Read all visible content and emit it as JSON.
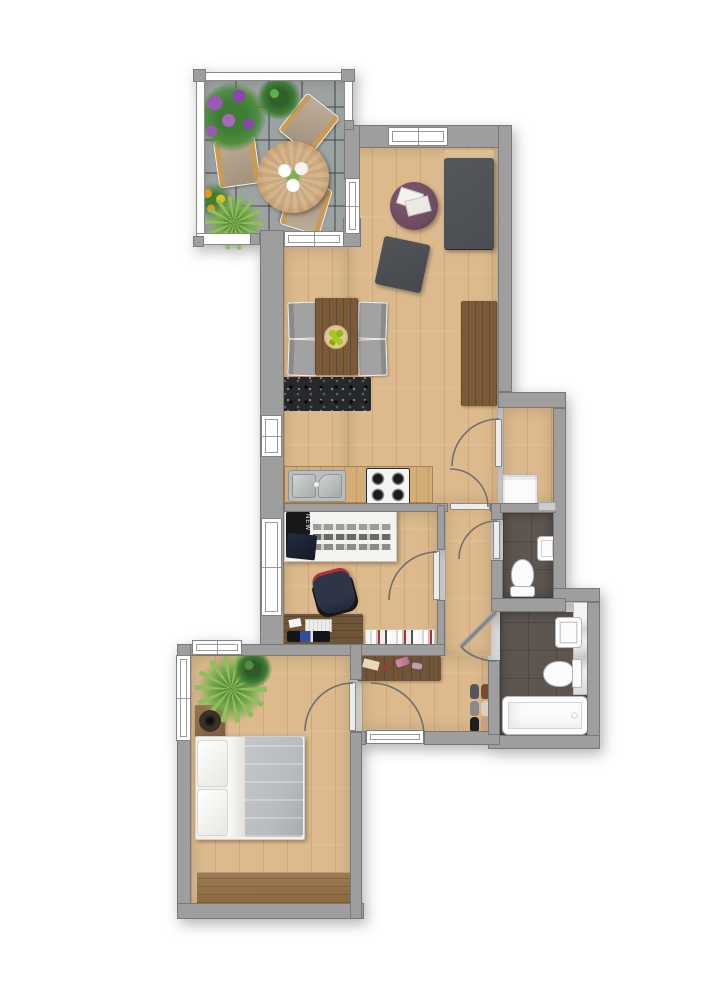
{
  "meta": {
    "type": "floor-plan",
    "description": "Top-down rendered apartment floor plan with terrace, living-dining room with open kitchen, office room, laundry niche, WC, bathroom, hallway and bedroom"
  },
  "texts": {
    "pillow": "NEW YORK"
  },
  "colors": {
    "wall": "#9e9e9e",
    "wood": "#dcba8d",
    "woodDark": "#7b5a39",
    "terraceTile": "#9da3a2",
    "bathTile": "#5d5550",
    "sofa": "#4a4d51",
    "sofaBack": "#d9c18f",
    "pouf": "#6e4b60",
    "ottoman": "#45484c",
    "chairGray": "#a2a2a2",
    "rug": "#26282a",
    "fixtureWhite": "#fbfbfb",
    "duvet": "#b9bcbf",
    "navy": "#2e3546",
    "bookRed": "#b03030",
    "plantLight": "#8fbf5a",
    "plantDark": "#3f7d35",
    "flowerPurple": "#9b59b6",
    "marigold": "#e8960f",
    "apple": "#a8c820",
    "seatTan": "#b7a795",
    "tableWood": "#c9a273"
  },
  "rooms": [
    {
      "id": "terrace",
      "items": [
        "railing",
        "stone-tiles",
        "purple-flower-bush",
        "fern-plant",
        "folding-chair",
        "folding-chair",
        "folding-chair",
        "round-table",
        "white-flower-centerpiece",
        "marigold-plant",
        "yucca-plant"
      ]
    },
    {
      "id": "living-dining-room",
      "items": [
        "sofa",
        "coffee-table-pouf",
        "magazines",
        "ottoman",
        "dining-table",
        "fruit-bowl",
        "dining-chair",
        "dining-chair",
        "dining-chair",
        "dining-chair",
        "speckled-rug",
        "sideboard"
      ]
    },
    {
      "id": "kitchen",
      "items": [
        "counter",
        "double-sink",
        "gas-stove"
      ]
    },
    {
      "id": "office-room",
      "items": [
        "single-bed",
        "skyline-duvet",
        "new-york-pillow",
        "desk-chair",
        "desk",
        "paper",
        "keyboard",
        "laptop",
        "mouse",
        "bookshelf"
      ]
    },
    {
      "id": "laundry-niche",
      "items": [
        "washing-machine",
        "threshold"
      ]
    },
    {
      "id": "wc",
      "items": [
        "hand-sink",
        "toilet"
      ]
    },
    {
      "id": "bathroom",
      "items": [
        "marble-panel",
        "washbasin",
        "toilet",
        "bathtub"
      ]
    },
    {
      "id": "hallway",
      "items": [
        "console-table",
        "cosmetics",
        "shoes-pair",
        "shoes-pair",
        "shoes-pair",
        "entrance-door"
      ]
    },
    {
      "id": "bedroom",
      "items": [
        "palm-plant",
        "green-plant",
        "nightstand-speaker",
        "double-bed",
        "pillows",
        "wardrobe"
      ]
    }
  ]
}
